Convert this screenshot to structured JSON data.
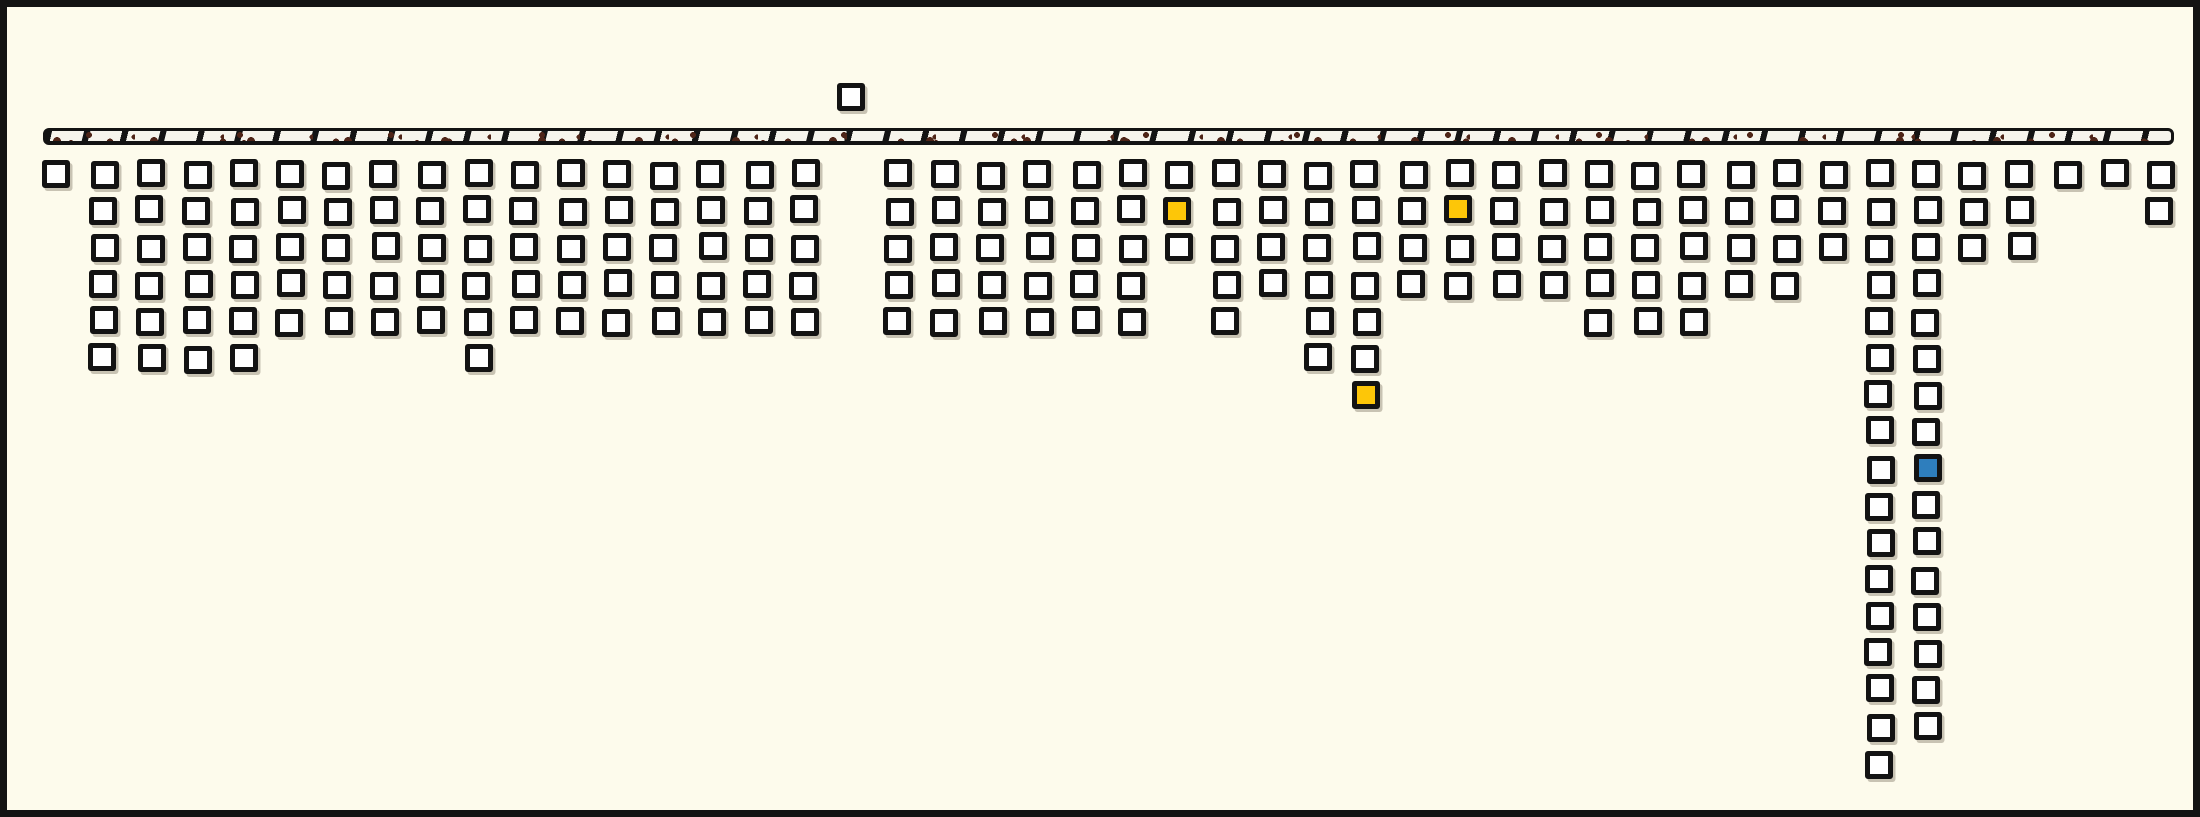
{
  "chart_data": {
    "type": "bar",
    "subtype": "unit-square-pictograph",
    "title": "",
    "xlabel": "",
    "ylabel": "",
    "description": "Untitled figure: a horizontal speckled ground bar near the top; 46 column slots of small white outlined unit squares stack downward below it. One slot's single square floats above the bar. Three squares are highlighted yellow, one blue. Two tall columns near the right extend far down.",
    "num_column_slots": 46,
    "values": [
      1,
      6,
      6,
      6,
      6,
      5,
      5,
      5,
      5,
      6,
      5,
      5,
      5,
      5,
      5,
      5,
      5,
      0,
      5,
      5,
      5,
      5,
      5,
      5,
      3,
      5,
      4,
      6,
      7,
      4,
      4,
      4,
      4,
      5,
      5,
      5,
      4,
      4,
      3,
      17,
      16,
      3,
      3,
      1,
      1,
      2
    ],
    "floating_square": {
      "column_index": 17,
      "position": "above_ground_line"
    },
    "highlighted_squares": [
      {
        "column_index": 24,
        "row": 2,
        "color_name": "yellow"
      },
      {
        "column_index": 30,
        "row": 2,
        "color_name": "yellow"
      },
      {
        "column_index": 28,
        "row": 7,
        "color_name": "yellow"
      },
      {
        "column_index": 40,
        "row": 9,
        "color_name": "blue"
      }
    ],
    "legend": null,
    "grid": false,
    "axis_ticks": "none"
  },
  "palette": {
    "background": "#fdfbec",
    "ink": "#131313",
    "square_fill": "#ffffff",
    "highlight_yellow": "#fdc608",
    "highlight_blue": "#2e7ebd",
    "ground_fill": "#f6f4ec",
    "ground_speckle": "#4e2417",
    "shadow": "rgba(147,140,122,0.5)"
  },
  "geometry": {
    "canvas_width": 2200,
    "canvas_height": 817,
    "column_start_x": 36,
    "column_spacing": 46.74,
    "row_start_y": 153,
    "row_spacing": 36.85,
    "square_outer_size": 28,
    "ground_bar": {
      "x": 36,
      "y": 121,
      "width": 2131,
      "height": 17
    },
    "floating_square": {
      "x": 830,
      "y": 76
    }
  }
}
